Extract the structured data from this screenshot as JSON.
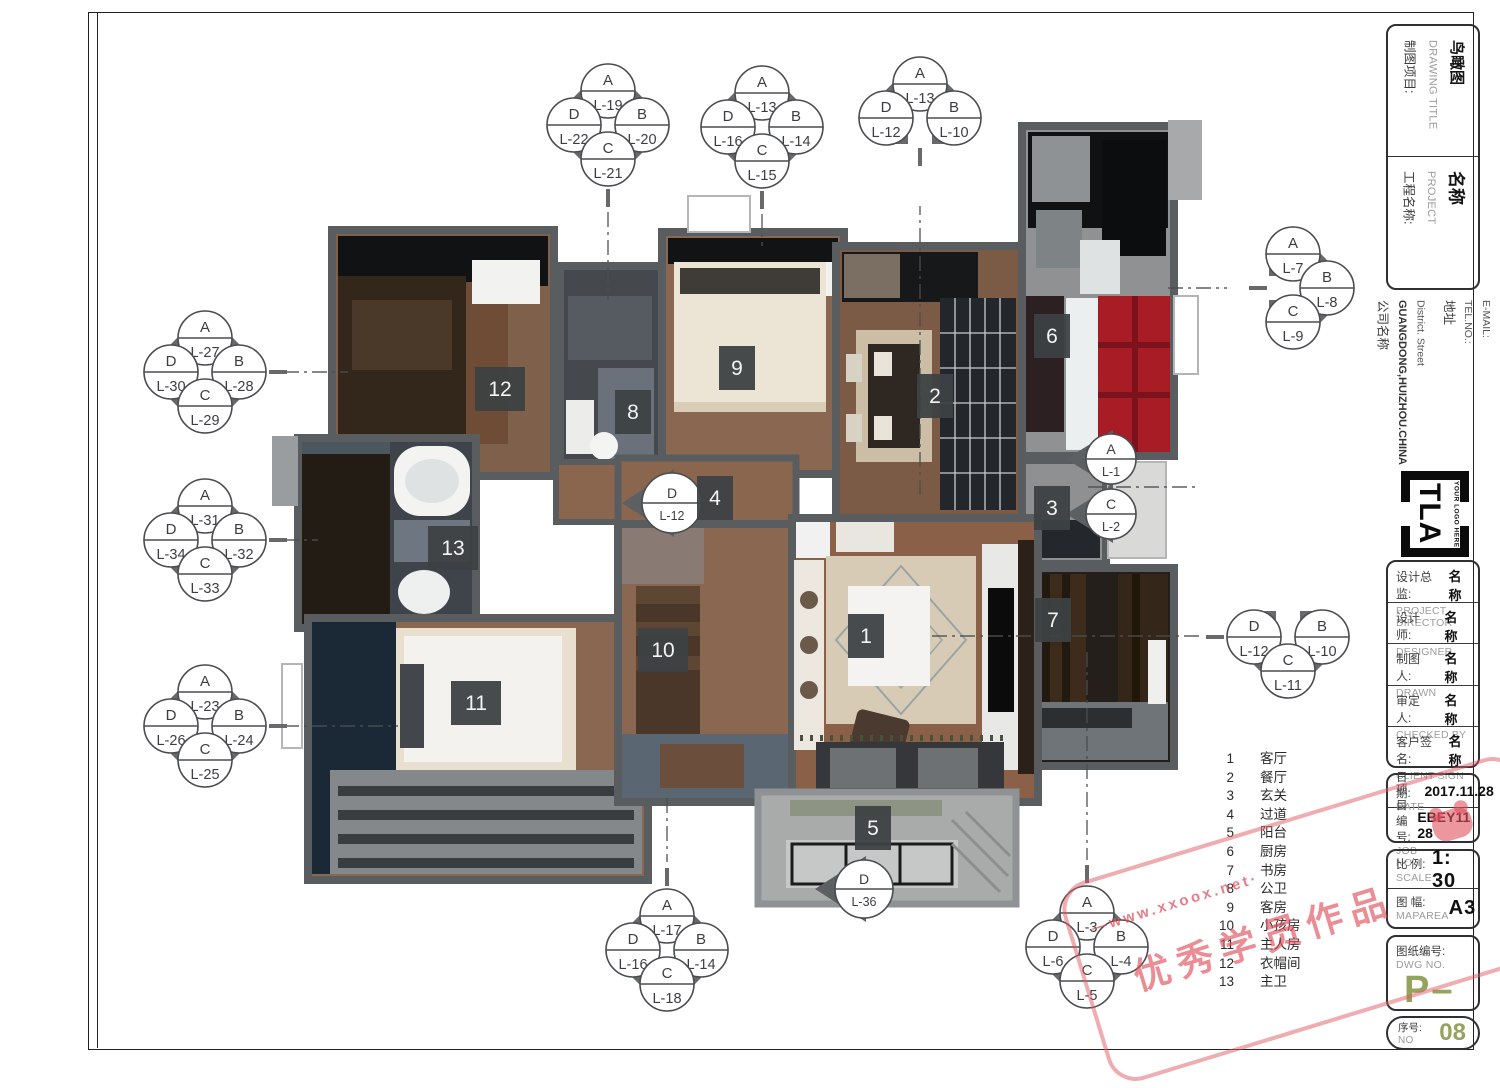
{
  "title_block": {
    "drawing": {
      "label_cn": "制图项目:",
      "label_en": "DRAWING TITLE",
      "value": "鸟瞰图"
    },
    "project": {
      "label_cn": "工程名称:",
      "label_en": "PROJECT",
      "value": "名称"
    },
    "company": {
      "label_cn": "公司名称",
      "name": "GUANGDONG,HUIZHOU.CHINA",
      "line2": "District.   Street",
      "addr_cn": "地址",
      "tel": "TEL.NO.:",
      "email": "E-MAIL:"
    },
    "logo": {
      "text": "TLA",
      "tagline": "YOUR LOGO HERE"
    },
    "people": [
      {
        "label_cn": "设计总监:",
        "value": "名称",
        "label_en": "PROJECT DIRECTOR"
      },
      {
        "label_cn": "设计师:",
        "value": "名称",
        "label_en": "DESIGNER"
      },
      {
        "label_cn": "制图人:",
        "value": "名称",
        "label_en": "DRAWN"
      },
      {
        "label_cn": "审定人:",
        "value": "名称",
        "label_en": "CHECKED BY"
      },
      {
        "label_cn": "客户签名:",
        "value": "名称",
        "label_en": "CLIENT SIGN"
      }
    ],
    "date": {
      "label_cn": "日 期:",
      "label_en": "DATE",
      "value": "2017.11.28"
    },
    "job": {
      "label_cn": "项目编号:",
      "label_en": "JOB NO",
      "value": "EBEY11 28"
    },
    "scale": {
      "label_cn": "比 例:",
      "label_en": "SCALE",
      "value": "1: 30"
    },
    "maparea": {
      "label_cn": "图 幅:",
      "label_en": "MAPAREA",
      "value": "A3"
    },
    "dwg": {
      "label_cn": "图纸编号:",
      "label_en": "DWG NO.",
      "value": "P–"
    },
    "serial": {
      "label_cn": "序号:",
      "label_en": "NO",
      "value": "08"
    }
  },
  "legend": {
    "items": [
      {
        "no": "1",
        "name": "客厅"
      },
      {
        "no": "2",
        "name": "餐厅"
      },
      {
        "no": "3",
        "name": "玄关"
      },
      {
        "no": "4",
        "name": "过道"
      },
      {
        "no": "5",
        "name": "阳台"
      },
      {
        "no": "6",
        "name": "厨房"
      },
      {
        "no": "7",
        "name": "书房"
      },
      {
        "no": "8",
        "name": "公卫"
      },
      {
        "no": "9",
        "name": "客房"
      },
      {
        "no": "10",
        "name": "小孩房"
      },
      {
        "no": "11",
        "name": "主人房"
      },
      {
        "no": "12",
        "name": "衣帽间"
      },
      {
        "no": "13",
        "name": "主卫"
      }
    ]
  },
  "plan": {
    "badges": [
      {
        "no": "1",
        "x": 866,
        "y": 636
      },
      {
        "no": "2",
        "x": 935,
        "y": 396
      },
      {
        "no": "3",
        "x": 1052,
        "y": 508
      },
      {
        "no": "4",
        "x": 715,
        "y": 498
      },
      {
        "no": "5",
        "x": 873,
        "y": 828
      },
      {
        "no": "6",
        "x": 1052,
        "y": 336
      },
      {
        "no": "7",
        "x": 1053,
        "y": 620
      },
      {
        "no": "8",
        "x": 633,
        "y": 412
      },
      {
        "no": "9",
        "x": 737,
        "y": 368
      },
      {
        "no": "10",
        "x": 663,
        "y": 650
      },
      {
        "no": "11",
        "x": 476,
        "y": 703
      },
      {
        "no": "12",
        "x": 500,
        "y": 389
      },
      {
        "no": "13",
        "x": 453,
        "y": 548
      }
    ],
    "markers": [
      {
        "type": "full",
        "cx": 608,
        "cy": 125,
        "stub": "bottom",
        "circles": {
          "A": "L-19",
          "D": "L-22",
          "B": "L-20",
          "C": "L-21"
        }
      },
      {
        "type": "full",
        "cx": 762,
        "cy": 127,
        "stub": "bottom",
        "circles": {
          "A": "L-13",
          "D": "L-16",
          "B": "L-14",
          "C": "L-15"
        }
      },
      {
        "type": "half-top",
        "cx": 920,
        "cy": 118,
        "stub": "bottom",
        "circles": {
          "A": "L-13",
          "D": "L-12",
          "B": "L-10"
        }
      },
      {
        "type": "full",
        "cx": 205,
        "cy": 372,
        "stub": "right",
        "circles": {
          "A": "L-27",
          "D": "L-30",
          "B": "L-28",
          "C": "L-29"
        }
      },
      {
        "type": "full",
        "cx": 205,
        "cy": 540,
        "stub": "right",
        "circles": {
          "A": "L-31",
          "D": "L-34",
          "B": "L-32",
          "C": "L-33"
        }
      },
      {
        "type": "full",
        "cx": 205,
        "cy": 726,
        "stub": "right",
        "circles": {
          "A": "L-23",
          "D": "L-26",
          "B": "L-24",
          "C": "L-25"
        }
      },
      {
        "type": "full",
        "cx": 667,
        "cy": 950,
        "stub": "top",
        "circles": {
          "A": "L-17",
          "D": "L-16",
          "B": "L-14",
          "C": "L-18"
        }
      },
      {
        "type": "full",
        "cx": 1087,
        "cy": 947,
        "stub": "top",
        "circles": {
          "A": "L-3",
          "D": "L-6",
          "B": "L-4",
          "C": "L-5"
        }
      },
      {
        "type": "half-right",
        "cx": 1293,
        "cy": 288,
        "stub": "left",
        "circles": {
          "A": "L-7",
          "B": "L-8",
          "C": "L-9"
        }
      },
      {
        "type": "half-bottom",
        "cx": 1288,
        "cy": 637,
        "stub": "left",
        "circles": {
          "D": "L-12",
          "B": "L-10",
          "C": "L-11"
        }
      }
    ],
    "circle_markers": [
      {
        "letter": "D",
        "label": "L-12",
        "x": 672,
        "y": 503,
        "r": 30
      },
      {
        "letter": "A",
        "label": "L-1",
        "x": 1111,
        "y": 459,
        "r": 25
      },
      {
        "letter": "C",
        "label": "L-2",
        "x": 1111,
        "y": 514,
        "r": 25
      },
      {
        "letter": "D",
        "label": "L-36",
        "x": 864,
        "y": 889,
        "r": 29
      }
    ]
  },
  "watermark": {
    "line1": "—www.xxoox.net·",
    "line2": "优秀学员作品"
  },
  "colors": {
    "kitchen_red": "#a81c26",
    "olive_green": "#96a35f",
    "marker_gray": "#67696b",
    "marker_stroke": "#4a4d4f",
    "badge_gray": "#3d4143",
    "watermark_red": "#e05560",
    "floor_wood": "#8a6750",
    "navy": "#1b2937"
  }
}
